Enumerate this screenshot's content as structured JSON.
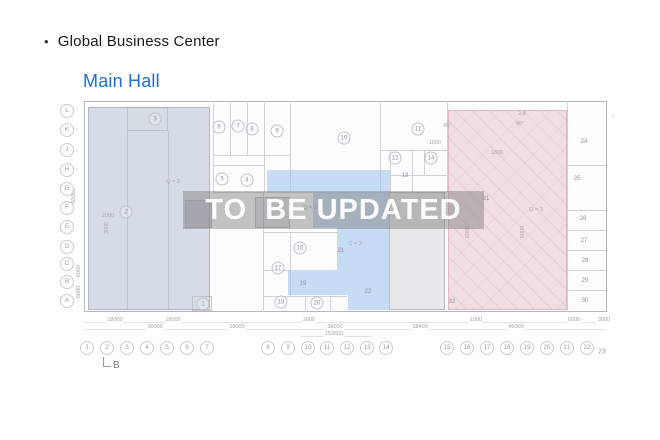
{
  "header": {
    "bullet": "•",
    "title": "Global Business Center"
  },
  "subtitle": {
    "label": "Main Hall",
    "color": "#1b6ed2"
  },
  "watermark": {
    "text": "TO  BE UPDATED",
    "band_color": "rgba(128,128,128,0.47)"
  },
  "plan": {
    "regions": {
      "left_hall": {
        "name": "left-hall-overlay",
        "color": "rgba(176,188,204,0.50)",
        "border": "rgba(125,140,160,0.45)"
      },
      "center_hall": {
        "name": "center-hall-overlay",
        "color": "rgba(164,196,236,0.60)",
        "border": "rgba(120,150,190,0.45)"
      },
      "right_hall": {
        "name": "right-hall-overlay",
        "color": "rgba(224,184,196,0.45)",
        "border": "rgba(190,140,155,0.40)"
      }
    },
    "row_labels": [
      {
        "n": "L",
        "x": 67,
        "y": 111
      },
      {
        "n": "K",
        "x": 67,
        "y": 130
      },
      {
        "n": "J",
        "x": 67,
        "y": 150
      },
      {
        "n": "H",
        "x": 67,
        "y": 170
      },
      {
        "n": "G",
        "x": 67,
        "y": 189
      },
      {
        "n": "F",
        "x": 67,
        "y": 208
      },
      {
        "n": "E",
        "x": 67,
        "y": 227
      },
      {
        "n": "D",
        "x": 67,
        "y": 247
      },
      {
        "n": "C",
        "x": 67,
        "y": 264
      },
      {
        "n": "B",
        "x": 67,
        "y": 282
      },
      {
        "n": "A",
        "x": 67,
        "y": 301
      }
    ],
    "col_labels": [
      {
        "n": "1",
        "x": 87,
        "y": 348,
        "circled": true
      },
      {
        "n": "2",
        "x": 107,
        "y": 348,
        "circled": true
      },
      {
        "n": "3",
        "x": 127,
        "y": 348,
        "circled": true
      },
      {
        "n": "4",
        "x": 147,
        "y": 348,
        "circled": true
      },
      {
        "n": "5",
        "x": 167,
        "y": 348,
        "circled": true
      },
      {
        "n": "6",
        "x": 187,
        "y": 348,
        "circled": true
      },
      {
        "n": "7",
        "x": 207,
        "y": 348,
        "circled": true
      },
      {
        "n": "8",
        "x": 268,
        "y": 348,
        "circled": true
      },
      {
        "n": "9",
        "x": 288,
        "y": 348,
        "circled": true
      },
      {
        "n": "10",
        "x": 308,
        "y": 348,
        "circled": true
      },
      {
        "n": "11",
        "x": 327,
        "y": 348,
        "circled": true
      },
      {
        "n": "12",
        "x": 347,
        "y": 348,
        "circled": true
      },
      {
        "n": "13",
        "x": 367,
        "y": 348,
        "circled": true
      },
      {
        "n": "14",
        "x": 386,
        "y": 348,
        "circled": true
      },
      {
        "n": "15",
        "x": 447,
        "y": 348,
        "circled": true
      },
      {
        "n": "16",
        "x": 467,
        "y": 348,
        "circled": true
      },
      {
        "n": "17",
        "x": 487,
        "y": 348,
        "circled": true
      },
      {
        "n": "18",
        "x": 507,
        "y": 348,
        "circled": true
      },
      {
        "n": "19",
        "x": 527,
        "y": 348,
        "circled": true
      },
      {
        "n": "20",
        "x": 547,
        "y": 348,
        "circled": true
      },
      {
        "n": "21",
        "x": 567,
        "y": 348,
        "circled": true
      },
      {
        "n": "22",
        "x": 587,
        "y": 348,
        "circled": true
      },
      {
        "n": "23",
        "x": 602,
        "y": 352,
        "circled": false
      }
    ],
    "rooms": [
      {
        "n": "1",
        "x": 203,
        "y": 304,
        "circled": true
      },
      {
        "n": "2",
        "x": 126,
        "y": 212,
        "circled": true
      },
      {
        "n": "3",
        "x": 155,
        "y": 119,
        "circled": true
      },
      {
        "n": "4",
        "x": 247,
        "y": 180,
        "circled": true
      },
      {
        "n": "5",
        "x": 222,
        "y": 179,
        "circled": true
      },
      {
        "n": "6",
        "x": 219,
        "y": 127,
        "circled": true
      },
      {
        "n": "7",
        "x": 238,
        "y": 126,
        "circled": true
      },
      {
        "n": "8",
        "x": 252,
        "y": 129,
        "circled": true
      },
      {
        "n": "9",
        "x": 277,
        "y": 131,
        "circled": true
      },
      {
        "n": "10",
        "x": 344,
        "y": 138,
        "circled": true
      },
      {
        "n": "11",
        "x": 418,
        "y": 129,
        "circled": true
      },
      {
        "n": "12",
        "x": 395,
        "y": 158,
        "circled": true
      },
      {
        "n": "13",
        "x": 405,
        "y": 176,
        "circled": false
      },
      {
        "n": "14",
        "x": 431,
        "y": 158,
        "circled": true
      },
      {
        "n": "15",
        "x": 300,
        "y": 248,
        "circled": true
      },
      {
        "n": "17",
        "x": 278,
        "y": 268,
        "circled": true
      },
      {
        "n": "18",
        "x": 281,
        "y": 302,
        "circled": true
      },
      {
        "n": "19",
        "x": 303,
        "y": 284,
        "circled": false
      },
      {
        "n": "20",
        "x": 317,
        "y": 303,
        "circled": true
      },
      {
        "n": "21",
        "x": 341,
        "y": 251,
        "circled": false
      },
      {
        "n": "22",
        "x": 368,
        "y": 292,
        "circled": false
      },
      {
        "n": "24",
        "x": 584,
        "y": 142,
        "circled": false
      },
      {
        "n": "25",
        "x": 577,
        "y": 179,
        "circled": false
      },
      {
        "n": "26",
        "x": 583,
        "y": 219,
        "circled": false
      },
      {
        "n": "27",
        "x": 584,
        "y": 241,
        "circled": false
      },
      {
        "n": "28",
        "x": 585,
        "y": 261,
        "circled": false
      },
      {
        "n": "29",
        "x": 585,
        "y": 281,
        "circled": false
      },
      {
        "n": "30",
        "x": 585,
        "y": 301,
        "circled": false
      },
      {
        "n": "31",
        "x": 486,
        "y": 199,
        "circled": false
      },
      {
        "n": "32",
        "x": 452,
        "y": 302,
        "circled": false
      }
    ],
    "annotations": [
      {
        "text": "Q = 3",
        "x": 173,
        "y": 182,
        "rot": false
      },
      {
        "text": "Q = 3",
        "x": 310,
        "y": 208,
        "rot": false
      },
      {
        "text": "Q = 3",
        "x": 355,
        "y": 244,
        "rot": false
      },
      {
        "text": "Q = 3",
        "x": 536,
        "y": 210,
        "rot": false
      },
      {
        "text": "2.8",
        "x": 522,
        "y": 114,
        "rot": false
      },
      {
        "text": "45°",
        "x": 447,
        "y": 126,
        "rot": false
      },
      {
        "text": "45°",
        "x": 520,
        "y": 124,
        "rot": false
      },
      {
        "text": "1800",
        "x": 497,
        "y": 153,
        "rot": false
      },
      {
        "text": "1000",
        "x": 435,
        "y": 143,
        "rot": false
      },
      {
        "text": "2000",
        "x": 108,
        "y": 216,
        "rot": false
      },
      {
        "text": "–",
        "x": 613,
        "y": 117,
        "rot": false
      },
      {
        "text": "3000",
        "x": 107,
        "y": 228,
        "rot": true
      },
      {
        "text": "6000",
        "x": 468,
        "y": 232,
        "rot": true
      },
      {
        "text": "6000",
        "x": 523,
        "y": 232,
        "rot": true
      },
      {
        "text": "60000",
        "x": 74,
        "y": 196,
        "rot": true
      },
      {
        "text": "6000",
        "x": 79,
        "y": 271,
        "rot": true
      },
      {
        "text": "6000",
        "x": 79,
        "y": 292,
        "rot": true
      }
    ],
    "dim_rows": [
      {
        "y": 320,
        "items": [
          {
            "text": "18000",
            "x": 115
          },
          {
            "text": "18000",
            "x": 173
          },
          {
            "text": "2000",
            "x": 309
          },
          {
            "text": "1000",
            "x": 476
          },
          {
            "text": "6000",
            "x": 574
          },
          {
            "text": "3000",
            "x": 604
          }
        ]
      },
      {
        "y": 327,
        "items": [
          {
            "text": "36000",
            "x": 155
          },
          {
            "text": "18000",
            "x": 237
          },
          {
            "text": "36000",
            "x": 335
          },
          {
            "text": "18400",
            "x": 420
          },
          {
            "text": "45000",
            "x": 516
          }
        ]
      },
      {
        "y": 334,
        "items": [
          {
            "text": "153600",
            "x": 334
          }
        ]
      }
    ],
    "section_marker": {
      "label": "B"
    }
  }
}
